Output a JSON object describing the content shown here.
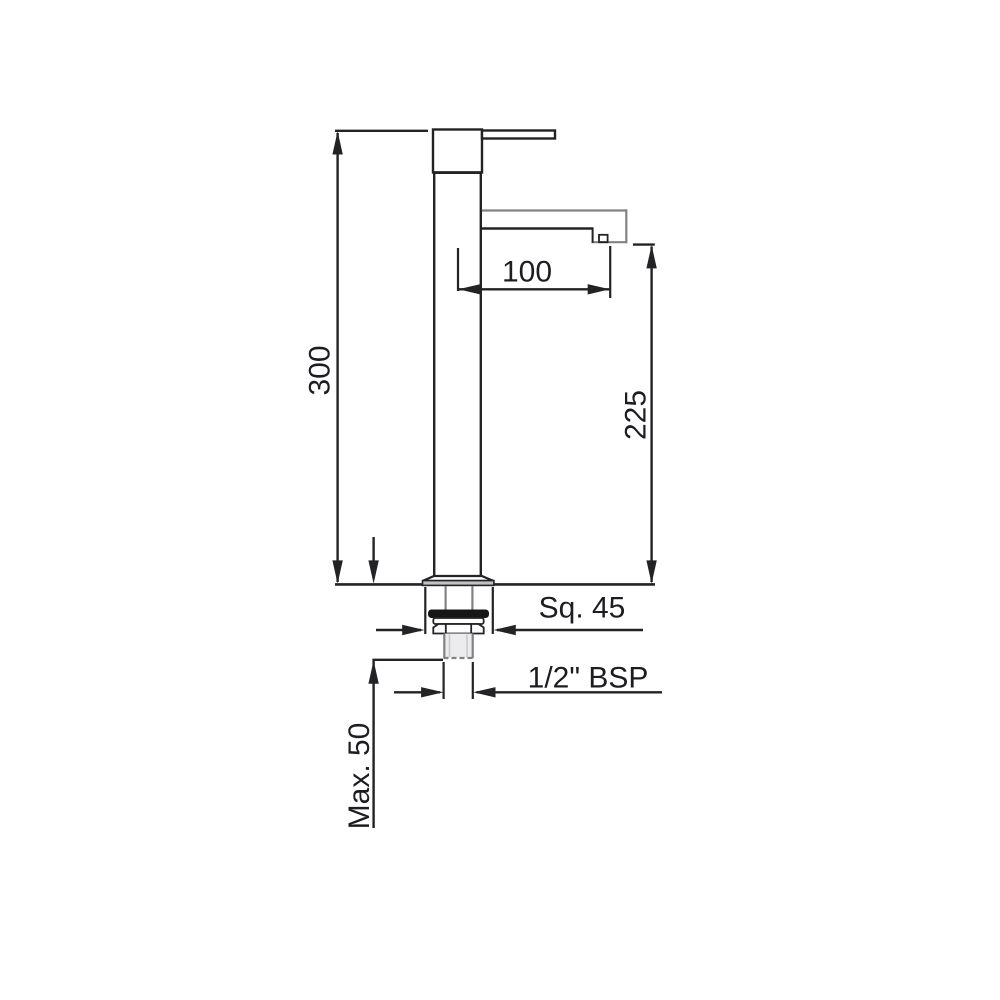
{
  "labels": {
    "overall_height": "300",
    "spout_projection": "100",
    "spout_height": "225",
    "base_square": "Sq. 45",
    "thread_size": "1/2\" BSP",
    "max_deck_thickness": "Max. 50"
  },
  "colors": {
    "ink": "#232326",
    "gray": "#828285",
    "text": "#1d1d21",
    "band": "#c2c2c4",
    "washer": "#161617",
    "shank": "#ececee",
    "thread": "#c9c9cb",
    "bg": "#ffffff"
  }
}
